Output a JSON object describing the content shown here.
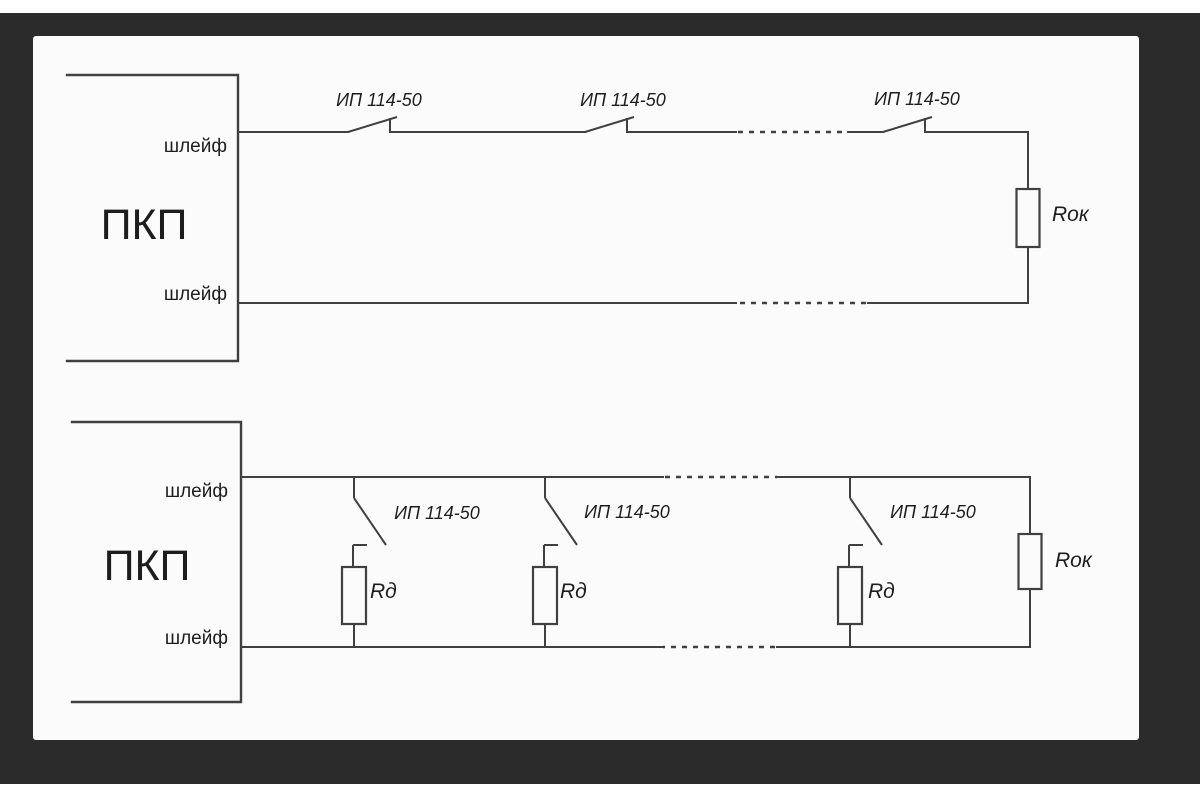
{
  "colors": {
    "frame": "#2b2b2b",
    "page": "#fbfbfb",
    "line": "#404040",
    "text": "#1d1d1d"
  },
  "top_diagram": {
    "panel": "ПКП",
    "loop_top": "шлейф",
    "loop_bottom": "шлейф",
    "detectors": [
      "ИП 114-50",
      "ИП 114-50",
      "ИП 114-50"
    ],
    "eol_resistor": "Rок"
  },
  "bottom_diagram": {
    "panel": "ПКП",
    "loop_top": "шлейф",
    "loop_bottom": "шлейф",
    "detectors": [
      "ИП 114-50",
      "ИП 114-50",
      "ИП 114-50"
    ],
    "branch_resistors": [
      "Rд",
      "Rд",
      "Rд"
    ],
    "eol_resistor": "Rок"
  }
}
